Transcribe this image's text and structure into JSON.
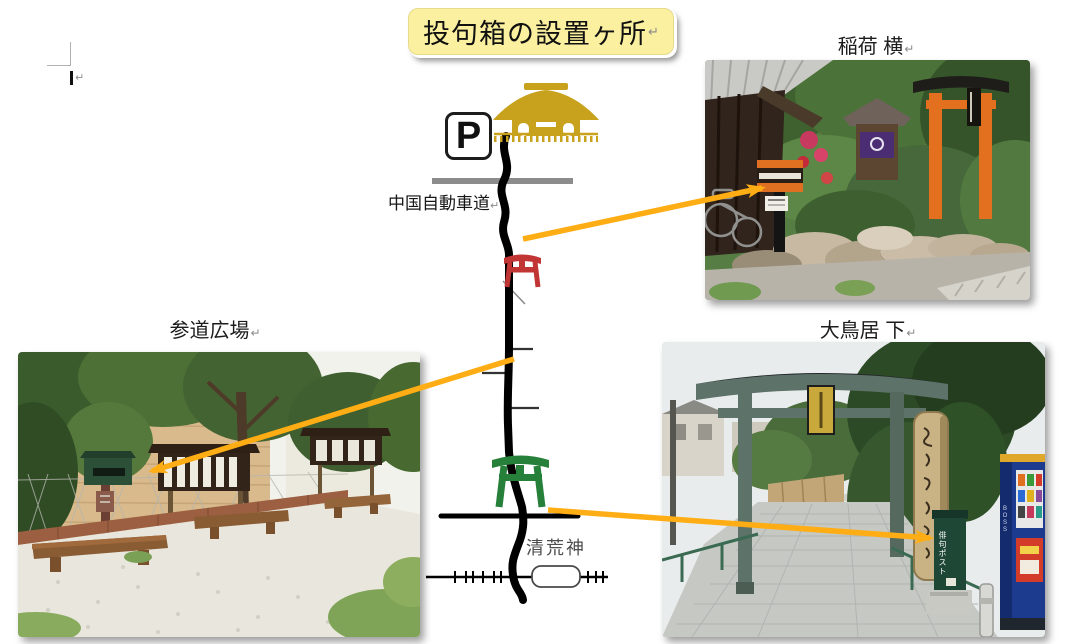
{
  "title": {
    "text": "投句箱の設置ヶ所"
  },
  "marks": {
    "return": "↵",
    "paragraph": "↵"
  },
  "captions": {
    "inari": "稲荷 横",
    "sando": "参道広場",
    "otorii": "大鳥居 下"
  },
  "map": {
    "expressway_label": "中国自動車道",
    "parking_sign": "P",
    "station_label": "清荒神"
  },
  "photo_otorii": {
    "post_label": "俳句ポスト",
    "vending_label": "BOSS"
  },
  "colors": {
    "arrow": "#FFAD14",
    "title_bg": "#FBF0A0",
    "road": "#000000",
    "expressway_gray": "#8C8C8C",
    "torii_red": "#C23535",
    "torii_green": "#27803A",
    "temple_gold": "#C9A21D"
  }
}
